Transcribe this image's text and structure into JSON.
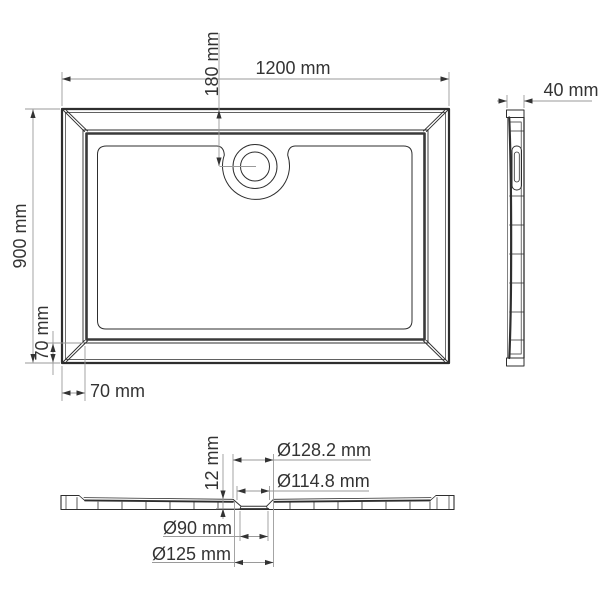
{
  "labels": {
    "top_view": {
      "overall_width": "1200 mm",
      "drain_from_top": "180 mm",
      "overall_depth": "900 mm",
      "rim_width_left": "70 mm",
      "rim_width_bottom": "70 mm"
    },
    "side_view": {
      "thickness": "40 mm"
    },
    "section_view": {
      "flange_dia": "Ø128.2 mm",
      "recess_dia": "Ø114.8 mm",
      "recess_depth": "12 mm",
      "waste_hole_dia": "Ø90 mm",
      "waste_outer_dia": "Ø125 mm"
    }
  },
  "colors": {
    "object_line": "#2e2e2e",
    "dimension_line": "#9a9a9a",
    "text": "#333333",
    "background": "#ffffff"
  }
}
